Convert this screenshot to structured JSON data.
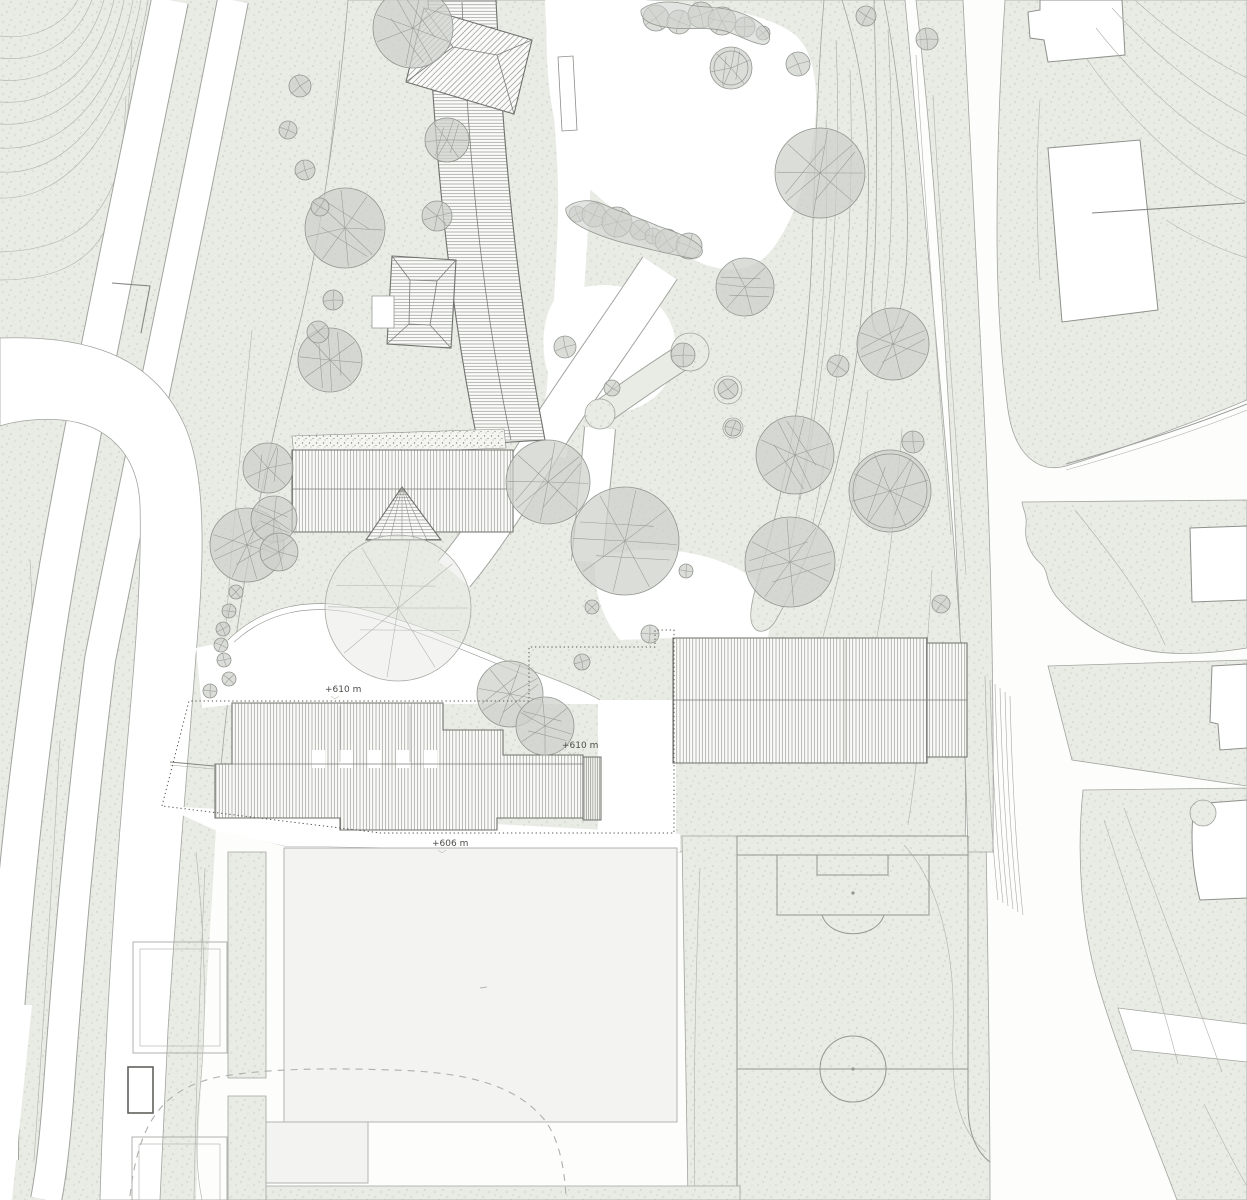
{
  "map": {
    "kind": "architectural-site-plan",
    "annotations": {
      "elevation_labels": [
        {
          "text": "+610 m"
        },
        {
          "text": "+610 m"
        },
        {
          "text": "+606 m"
        }
      ]
    },
    "colors": {
      "paper": "#fdfdfc",
      "terrain": "#e9ebe5",
      "terrain_speckle": "#d7dad2",
      "contour": "#b3b6af",
      "tree_fill": "#cdd0cb",
      "tree_outline": "#93958f",
      "building_hatch": "#83857f",
      "building_outline": "#6f716c",
      "context_building_fill": "#ffffff",
      "context_building_outline": "#8e908b",
      "playground_fill": "#f3f4f1",
      "field_line": "#94968f",
      "boundary_dotted": "#555752",
      "label_text": "#4b4d48"
    },
    "features": {
      "site_buildings": [
        "curved-hall",
        "hip-roof-house-north",
        "hip-roof-house-mid",
        "long-building-west",
        "spire-pavilion",
        "school-stepped-building",
        "stair-annex",
        "gym-hall"
      ],
      "context_buildings_count": 7,
      "sports_field": "soccer-pitch",
      "playground": true,
      "courts_count": 2,
      "trees": [
        [
          398,
          608,
          73,
          2
        ],
        [
          413,
          28,
          40,
          0
        ],
        [
          447,
          140,
          22,
          0
        ],
        [
          437,
          216,
          15,
          0
        ],
        [
          345,
          228,
          40,
          0
        ],
        [
          330,
          360,
          32,
          0
        ],
        [
          300,
          86,
          11,
          0
        ],
        [
          288,
          130,
          9,
          0
        ],
        [
          305,
          170,
          10,
          0
        ],
        [
          320,
          207,
          9,
          0
        ],
        [
          333,
          300,
          10,
          0
        ],
        [
          318,
          332,
          11,
          0
        ],
        [
          268,
          468,
          25,
          0
        ],
        [
          247,
          545,
          37,
          0
        ],
        [
          274,
          519,
          23,
          0
        ],
        [
          279,
          552,
          19,
          0
        ],
        [
          236,
          592,
          7,
          0
        ],
        [
          229,
          611,
          7,
          0
        ],
        [
          223,
          629,
          7,
          0
        ],
        [
          221,
          645,
          7,
          0
        ],
        [
          224,
          660,
          7,
          0
        ],
        [
          229,
          679,
          7,
          0
        ],
        [
          210,
          691,
          7,
          0
        ],
        [
          656,
          18,
          13,
          0
        ],
        [
          679,
          22,
          12,
          0
        ],
        [
          701,
          15,
          13,
          0
        ],
        [
          722,
          21,
          14,
          0
        ],
        [
          745,
          27,
          10,
          0
        ],
        [
          763,
          33,
          7,
          0
        ],
        [
          731,
          68,
          21,
          1
        ],
        [
          798,
          64,
          12,
          0
        ],
        [
          866,
          16,
          10,
          0
        ],
        [
          927,
          39,
          11,
          0
        ],
        [
          820,
          173,
          45,
          0
        ],
        [
          745,
          287,
          29,
          0
        ],
        [
          577,
          214,
          8,
          0
        ],
        [
          594,
          215,
          12,
          0
        ],
        [
          617,
          222,
          15,
          0
        ],
        [
          640,
          230,
          10,
          0
        ],
        [
          653,
          236,
          8,
          0
        ],
        [
          667,
          241,
          12,
          0
        ],
        [
          689,
          246,
          13,
          0
        ],
        [
          565,
          347,
          11,
          0
        ],
        [
          612,
          388,
          8,
          0
        ],
        [
          683,
          355,
          12,
          0
        ],
        [
          728,
          389,
          10,
          0
        ],
        [
          733,
          428,
          8,
          0
        ],
        [
          893,
          344,
          36,
          0
        ],
        [
          838,
          366,
          11,
          0
        ],
        [
          913,
          442,
          11,
          0
        ],
        [
          548,
          482,
          42,
          0
        ],
        [
          625,
          541,
          54,
          0
        ],
        [
          795,
          455,
          39,
          0
        ],
        [
          890,
          491,
          41,
          1
        ],
        [
          790,
          562,
          45,
          0
        ],
        [
          592,
          607,
          7,
          0
        ],
        [
          686,
          571,
          7,
          0
        ],
        [
          510,
          694,
          33,
          0
        ],
        [
          545,
          726,
          29,
          0
        ],
        [
          582,
          662,
          8,
          0
        ],
        [
          941,
          604,
          9,
          0
        ],
        [
          650,
          634,
          9,
          0
        ]
      ]
    }
  }
}
